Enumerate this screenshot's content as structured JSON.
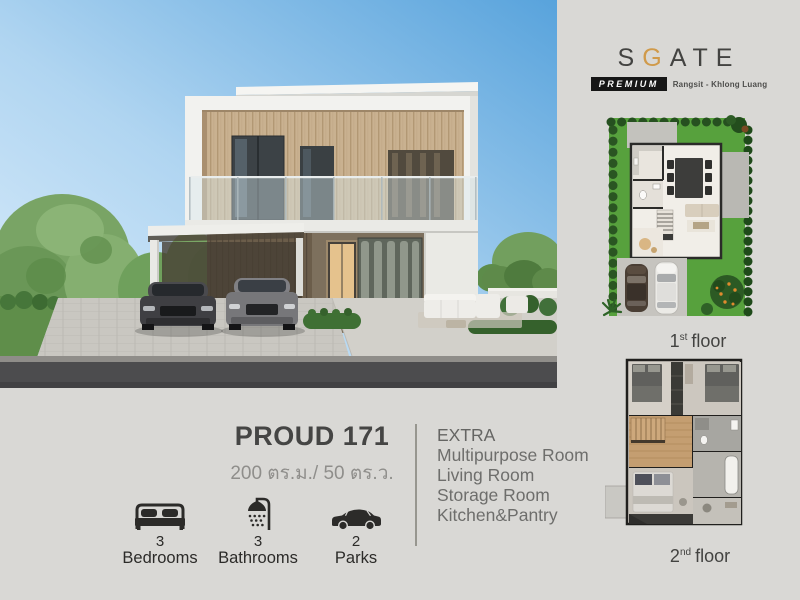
{
  "colors": {
    "accent_gold": "#d09a4a",
    "badge_bg": "#161616",
    "text_dark": "#454544",
    "text_gray": "#6e6e6c",
    "lawn_green": "#57a13d"
  },
  "logo": {
    "letters_pre": "S",
    "letter_accent": "G",
    "letters_post": "ATE",
    "badge": "PREMIUM",
    "location": "Rangsit - Khlong Luang"
  },
  "property": {
    "name": "PROUD 171",
    "area": "200 ตร.ม./ 50 ตร.ว."
  },
  "extra": {
    "heading": "EXTRA",
    "items": [
      "Multipurpose Room",
      "Living Room",
      "Storage Room",
      "Kitchen&Pantry"
    ]
  },
  "features": {
    "bedrooms": {
      "count": "3",
      "label": "Bedrooms"
    },
    "bathrooms": {
      "count": "3",
      "label": "Bathrooms"
    },
    "parks": {
      "count": "2",
      "label": "Parks"
    }
  },
  "floor_plans": {
    "first": {
      "number": "1",
      "ordinal": "st",
      "word": "floor"
    },
    "second": {
      "number": "2",
      "ordinal": "nd",
      "word": "floor"
    }
  }
}
